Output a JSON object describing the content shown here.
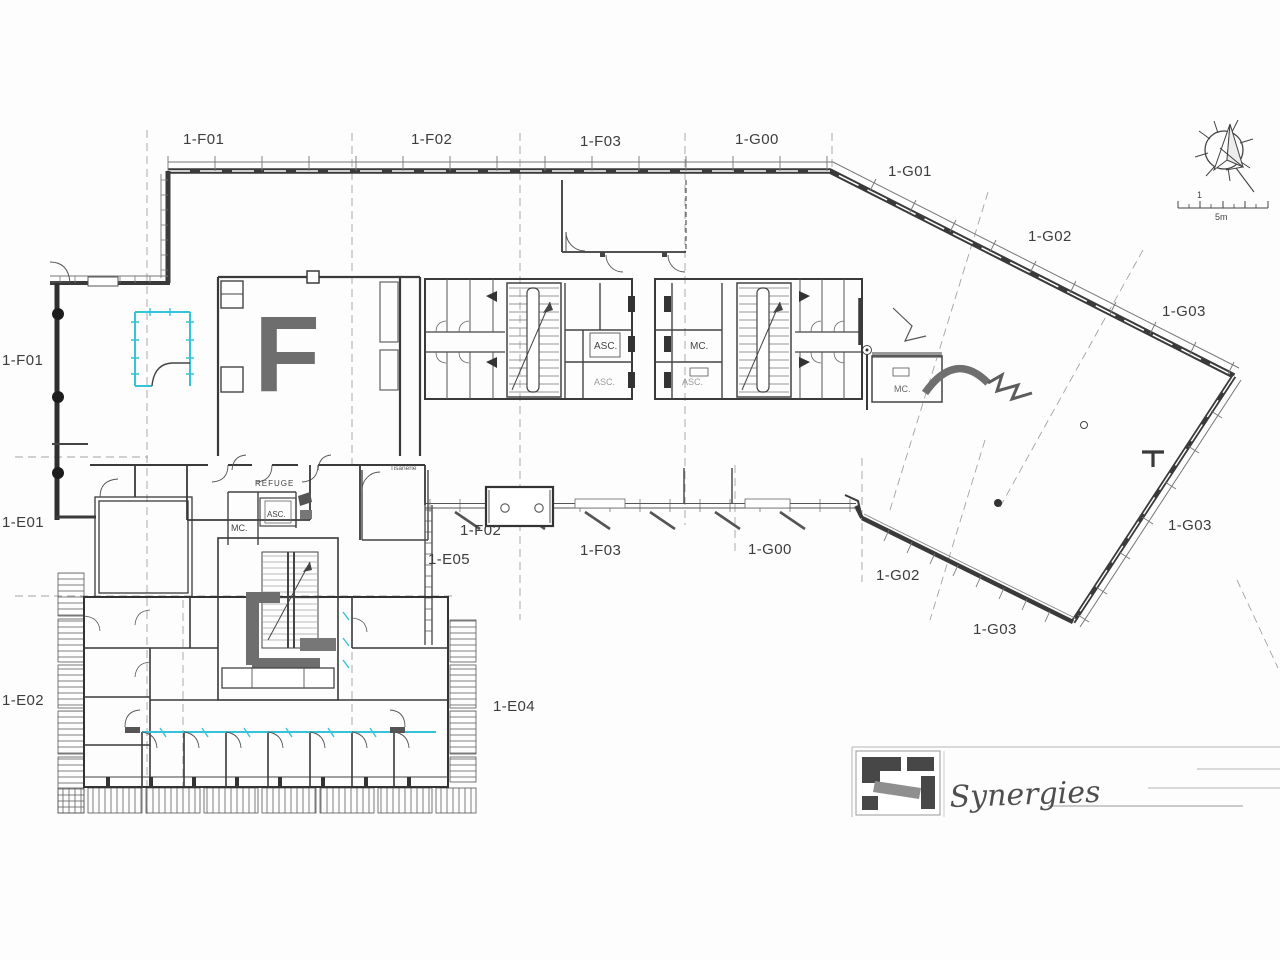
{
  "zone_labels": [
    {
      "text": "1-F01"
    },
    {
      "text": "1-F02"
    },
    {
      "text": "1-F03"
    },
    {
      "text": "1-G00"
    },
    {
      "text": "1-G01"
    },
    {
      "text": "1-G02"
    },
    {
      "text": "1-G03"
    },
    {
      "text": "1-F01"
    },
    {
      "text": "1-E01"
    },
    {
      "text": "1-E02"
    },
    {
      "text": "1-F02"
    },
    {
      "text": "1-E05"
    },
    {
      "text": "1-F03"
    },
    {
      "text": "1-G00"
    },
    {
      "text": "1-G02"
    },
    {
      "text": "1-G03"
    },
    {
      "text": "1-G03"
    },
    {
      "text": "1-E04"
    }
  ],
  "annotations": {
    "refuge": "REFUGE",
    "asc": "ASC.",
    "mc": "MC.",
    "tisanerie": "Tisanerie",
    "block_letter": "F"
  },
  "scale_bar": {
    "major_label": "1",
    "unit_label": "5m"
  },
  "logo": {
    "company": "Synergies"
  },
  "colors": {
    "wall": "#3a3a3a",
    "partition_accent": "#35c4d7",
    "label_text": "#3d3d3d",
    "room_letter": "#6e6e6e",
    "logo_dark": "#474747",
    "logo_gray": "#8f8f8f"
  }
}
